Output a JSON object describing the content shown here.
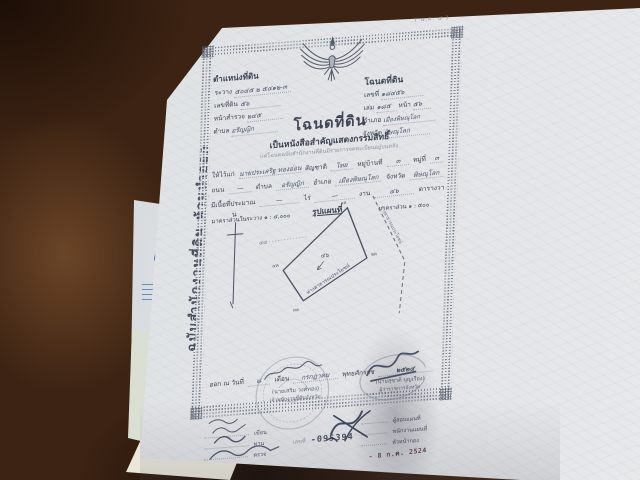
{
  "corner_code": "( น.ส. ๔ )",
  "margin_note": "ฉบับสำนักงานที่ดิน ห้ามนำออก",
  "position_block": {
    "title": "ตำแหน่งที่ดิน",
    "rows": [
      {
        "label": "ระวาง",
        "value": "๕๐๔๕ ๒ ๕๔๑๒-๓"
      },
      {
        "label": "เลขที่ดิน",
        "value": "๕๖"
      },
      {
        "label": "หน้าสำรวจ",
        "value": "๒๔๕"
      },
      {
        "label": "ตำบล",
        "value": "อรัญญิก"
      }
    ]
  },
  "deed_block": {
    "title": "โฉนดที่ดิน",
    "rows": [
      {
        "label": "เลขที่",
        "value": "๑๘๔๕๖"
      },
      {
        "label": "เล่ม",
        "value": "๑๘๕",
        "label2": "หน้า",
        "value2": "๕๖"
      },
      {
        "label": "อำเภอ",
        "value": "เมืองพิษณุโลก"
      },
      {
        "label": "จังหวัด",
        "value": "พิษณุโลก"
      }
    ]
  },
  "title_block": {
    "title": "โฉนดที่ดิน",
    "subtitle": "เป็นหนังสือสำคัญแสดงกรรมสิทธิ์",
    "note": "แต่โฉนดฉบับสำนักงานที่ดินมีรายการจดทะเบียนอยู่บนหลัง"
  },
  "owner_block": {
    "given_label": "ให้ไว้แก่",
    "name": "นายประเสริฐ ทองอ่อน",
    "nationality_label": "สัญชาติ",
    "nationality": "ไทย",
    "village_label": "หมู่บ้านที่",
    "village": "๓",
    "moo_label": "หมู่ที่",
    "moo": "๓",
    "road_label": "ถนน",
    "road": "—",
    "tambon_label": "ตำบล",
    "tambon": "อรัญญิก",
    "amphoe_label": "อำเภอ",
    "amphoe": "เมืองพิษณุโลก",
    "province_label": "จังหวัด",
    "province": "พิษณุโลก",
    "area_label": "มีเนื้อที่ประมาณ",
    "rai": "—",
    "rai_label": "ไร่",
    "ngan": "—",
    "ngan_label": "งาน",
    "wa": "๔๖",
    "wa_label": "ตารางวา"
  },
  "scale_line": {
    "left": "มาตราส่วนในระวาง ๑ : ๔,๐๐๐",
    "center": "รูปแผนที่",
    "right": "มาตราส่วน ๑ : ๕๐๐"
  },
  "map": {
    "north": "น",
    "neighbor": "๔๔",
    "area": "๔๖",
    "road1": "ทางสาธารณประโยชน์",
    "road2": "ทางสาธารณประโยชน์",
    "corners": [
      "๑ค",
      "๒ค",
      "๓ค",
      "๔ค"
    ]
  },
  "issue_line": {
    "prefix": "ออก ณ วันที่",
    "day": "๘",
    "month_label": "เดือน",
    "month": "กรกฎาคม",
    "era_label": "พุทธศักราช",
    "year": "๒๕๒๔"
  },
  "seals": {
    "left": {
      "name": "(นายเสริม วงศ์ทอง)",
      "title": "เจ้าพนักงานที่ดินจังหวัด"
    },
    "right": {
      "name": "(นายสุชาติ บุญเรือง)",
      "title": "ผู้ว่าราชการจังหวัด"
    }
  },
  "sign_left": {
    "rows": [
      "เขียน",
      "ทาน",
      "ตรวจ"
    ]
  },
  "serial": {
    "label": "เลขที่",
    "number": "-095394"
  },
  "sign_right": {
    "rows": [
      "ผู้สอบแผนที่",
      "พนักงานแผนที่",
      "หัวหน้ากอง"
    ],
    "date_stamp": "- 8 ก.ค. 2524"
  },
  "colors": {
    "background_wood": "#3c2313",
    "paper": "#e2e4e7",
    "print_ink": "#3e4453",
    "handwriting_ink": "#4a536b",
    "stamp_date_red": "#63434b",
    "logo_blue": "#2b63c9"
  }
}
